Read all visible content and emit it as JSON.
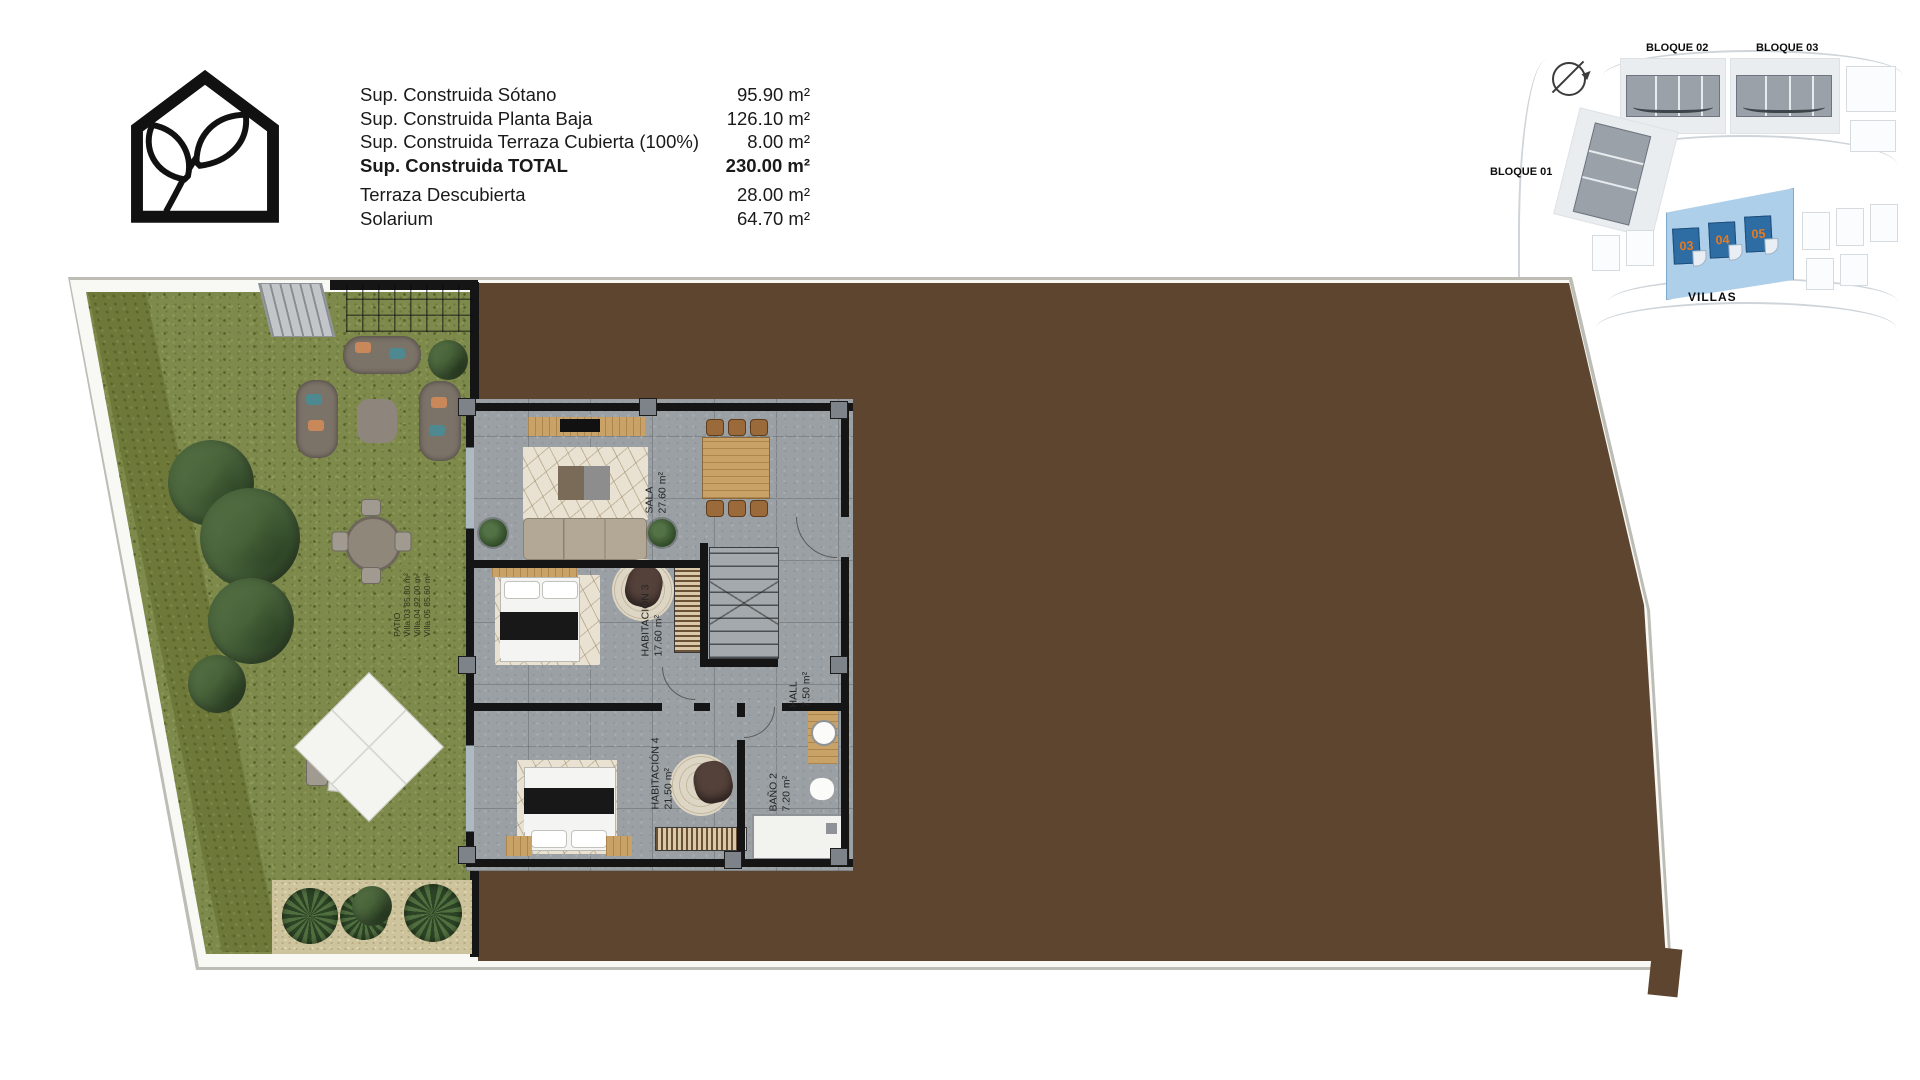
{
  "header": {
    "areas": {
      "rows": [
        {
          "label": "Sup. Construida Sótano",
          "value": "95.90 m²"
        },
        {
          "label": "Sup. Construida Planta Baja",
          "value": "126.10 m²"
        },
        {
          "label": "Sup. Construida Terraza Cubierta (100%)",
          "value": "8.00 m²"
        },
        {
          "label": "Sup. Construida TOTAL",
          "value": "230.00 m²"
        },
        {
          "label": "Terraza Descubierta",
          "value": "28.00 m²"
        },
        {
          "label": "Solarium",
          "value": "64.70 m²"
        }
      ]
    }
  },
  "site_map": {
    "labels": {
      "bloque01": "BLOQUE 01",
      "bloque02": "BLOQUE 02",
      "bloque03": "BLOQUE 03",
      "villas": "VILLAS"
    },
    "villas": [
      {
        "number": "03"
      },
      {
        "number": "04"
      },
      {
        "number": "05"
      }
    ],
    "colors": {
      "plot_highlight": "#aecfe9",
      "villa_building": "#2e6da4",
      "villa_number": "#e87a1e"
    }
  },
  "plan": {
    "rooms": [
      {
        "name": "SALA",
        "area": "27.60 m²"
      },
      {
        "name": "HABITACIÓN 3",
        "area": "17.60 m²"
      },
      {
        "name": "HALL",
        "area": "7.50 m²"
      },
      {
        "name": "HABITACIÓN 4",
        "area": "21.50 m²"
      },
      {
        "name": "BAÑO 2",
        "area": "7.20 m²"
      }
    ],
    "patio": {
      "title": "PATIO",
      "lines": [
        "Villa 03  85.80 m²",
        "Villa 04  92.00 m²",
        "Villa 05  85.60 m²"
      ]
    },
    "colors": {
      "grass": "#7e8a4b",
      "gravel": "#5e4530",
      "wall": "#151515",
      "wood": "#c9a268"
    }
  },
  "icons": {
    "logo": "house-leaf-logo-icon",
    "compass": "compass-icon"
  }
}
